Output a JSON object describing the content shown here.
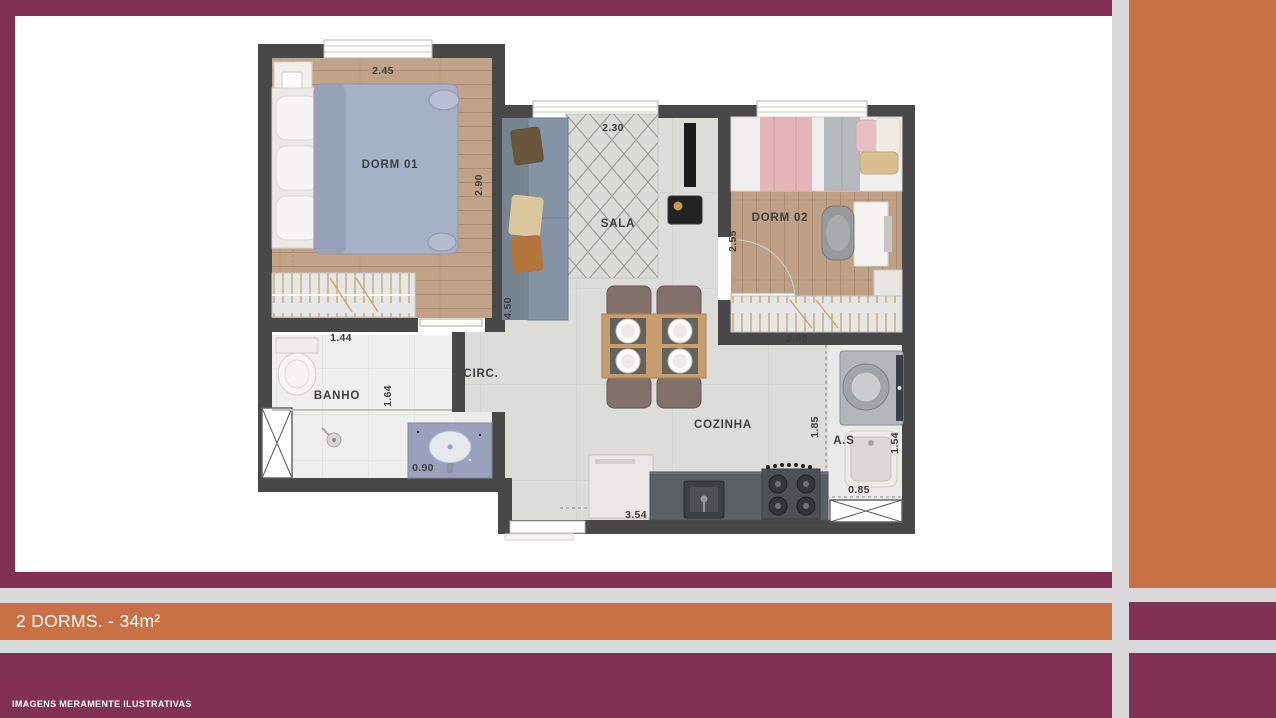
{
  "colors": {
    "maroon": "#833152",
    "orange": "#C97044",
    "background": "#D9D9D9",
    "wall": "#484848",
    "ink": "#3E3E3E"
  },
  "banner": {
    "label": "2 DORMS. - 34m²"
  },
  "footer": {
    "disclaimer": "IMAGENS MERAMENTE ILUSTRATIVAS"
  },
  "floorplan": {
    "room_labels": [
      {
        "id": "dorm01",
        "text": "DORM 01"
      },
      {
        "id": "sala",
        "text": "SALA"
      },
      {
        "id": "dorm02",
        "text": "DORM 02"
      },
      {
        "id": "banho",
        "text": "BANHO"
      },
      {
        "id": "circ",
        "text": "CIRC."
      },
      {
        "id": "cozinha",
        "text": "COZINHA"
      },
      {
        "id": "as",
        "text": "A.S"
      }
    ],
    "dimensions": [
      {
        "of": "dorm01-width",
        "text": "2.45"
      },
      {
        "of": "dorm01-depth",
        "text": "2.90"
      },
      {
        "of": "sala-width",
        "text": "2.30"
      },
      {
        "of": "dorm02-depth",
        "text": "2.55"
      },
      {
        "of": "dorm02-width",
        "text": "2.00"
      },
      {
        "of": "banho-width",
        "text": "1.44"
      },
      {
        "of": "banho-depth",
        "text": "1.64"
      },
      {
        "of": "lavatory-width",
        "text": "0.90"
      },
      {
        "of": "circ-depth",
        "text": "4.50"
      },
      {
        "of": "cozinha-width",
        "text": "3.54"
      },
      {
        "of": "cozinha-depth",
        "text": "1.85"
      },
      {
        "of": "as-depth",
        "text": "1.54"
      },
      {
        "of": "as-width",
        "text": "0.85"
      }
    ]
  }
}
